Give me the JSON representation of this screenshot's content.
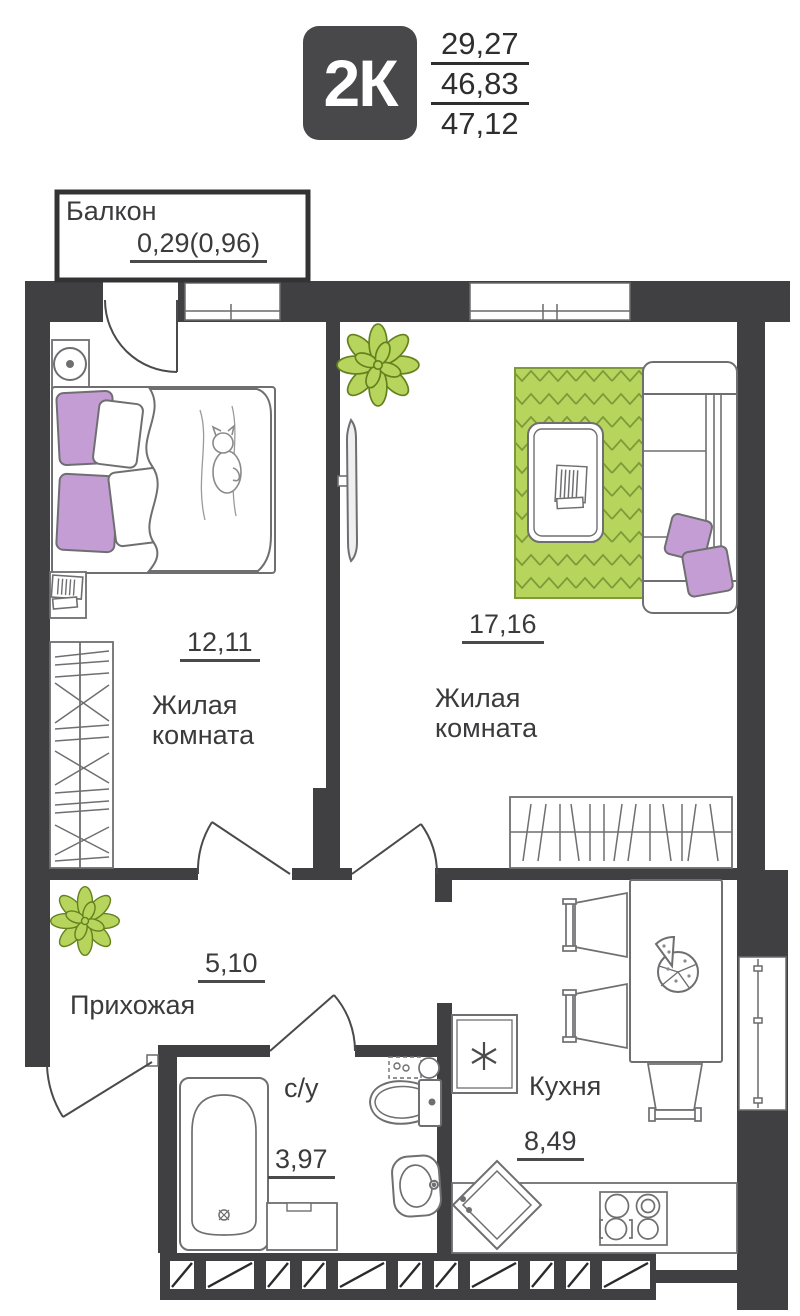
{
  "header": {
    "type_label": "2К",
    "upper_area": "29,27",
    "middle_area": "46,83",
    "total_area": "47,12"
  },
  "rooms": {
    "balcony": {
      "name": "Балкон",
      "area": "0,29(0,96)"
    },
    "bedroom": {
      "name": "Жилая комната",
      "area": "12,11"
    },
    "living": {
      "name": "Жилая комната",
      "area": "17,16"
    },
    "hallway": {
      "name": "Прихожая",
      "area": "5,10"
    },
    "bathroom": {
      "name": "с/у",
      "area": "3,97"
    },
    "kitchen": {
      "name": "Кухня",
      "area": "8,49"
    }
  },
  "colors": {
    "wall": "#404042",
    "badge": "#48484a",
    "accent_green": "#b7d55c",
    "accent_green_dark": "#64801f",
    "accent_purple": "#c59dd5",
    "furniture_line": "#6f6f72"
  }
}
